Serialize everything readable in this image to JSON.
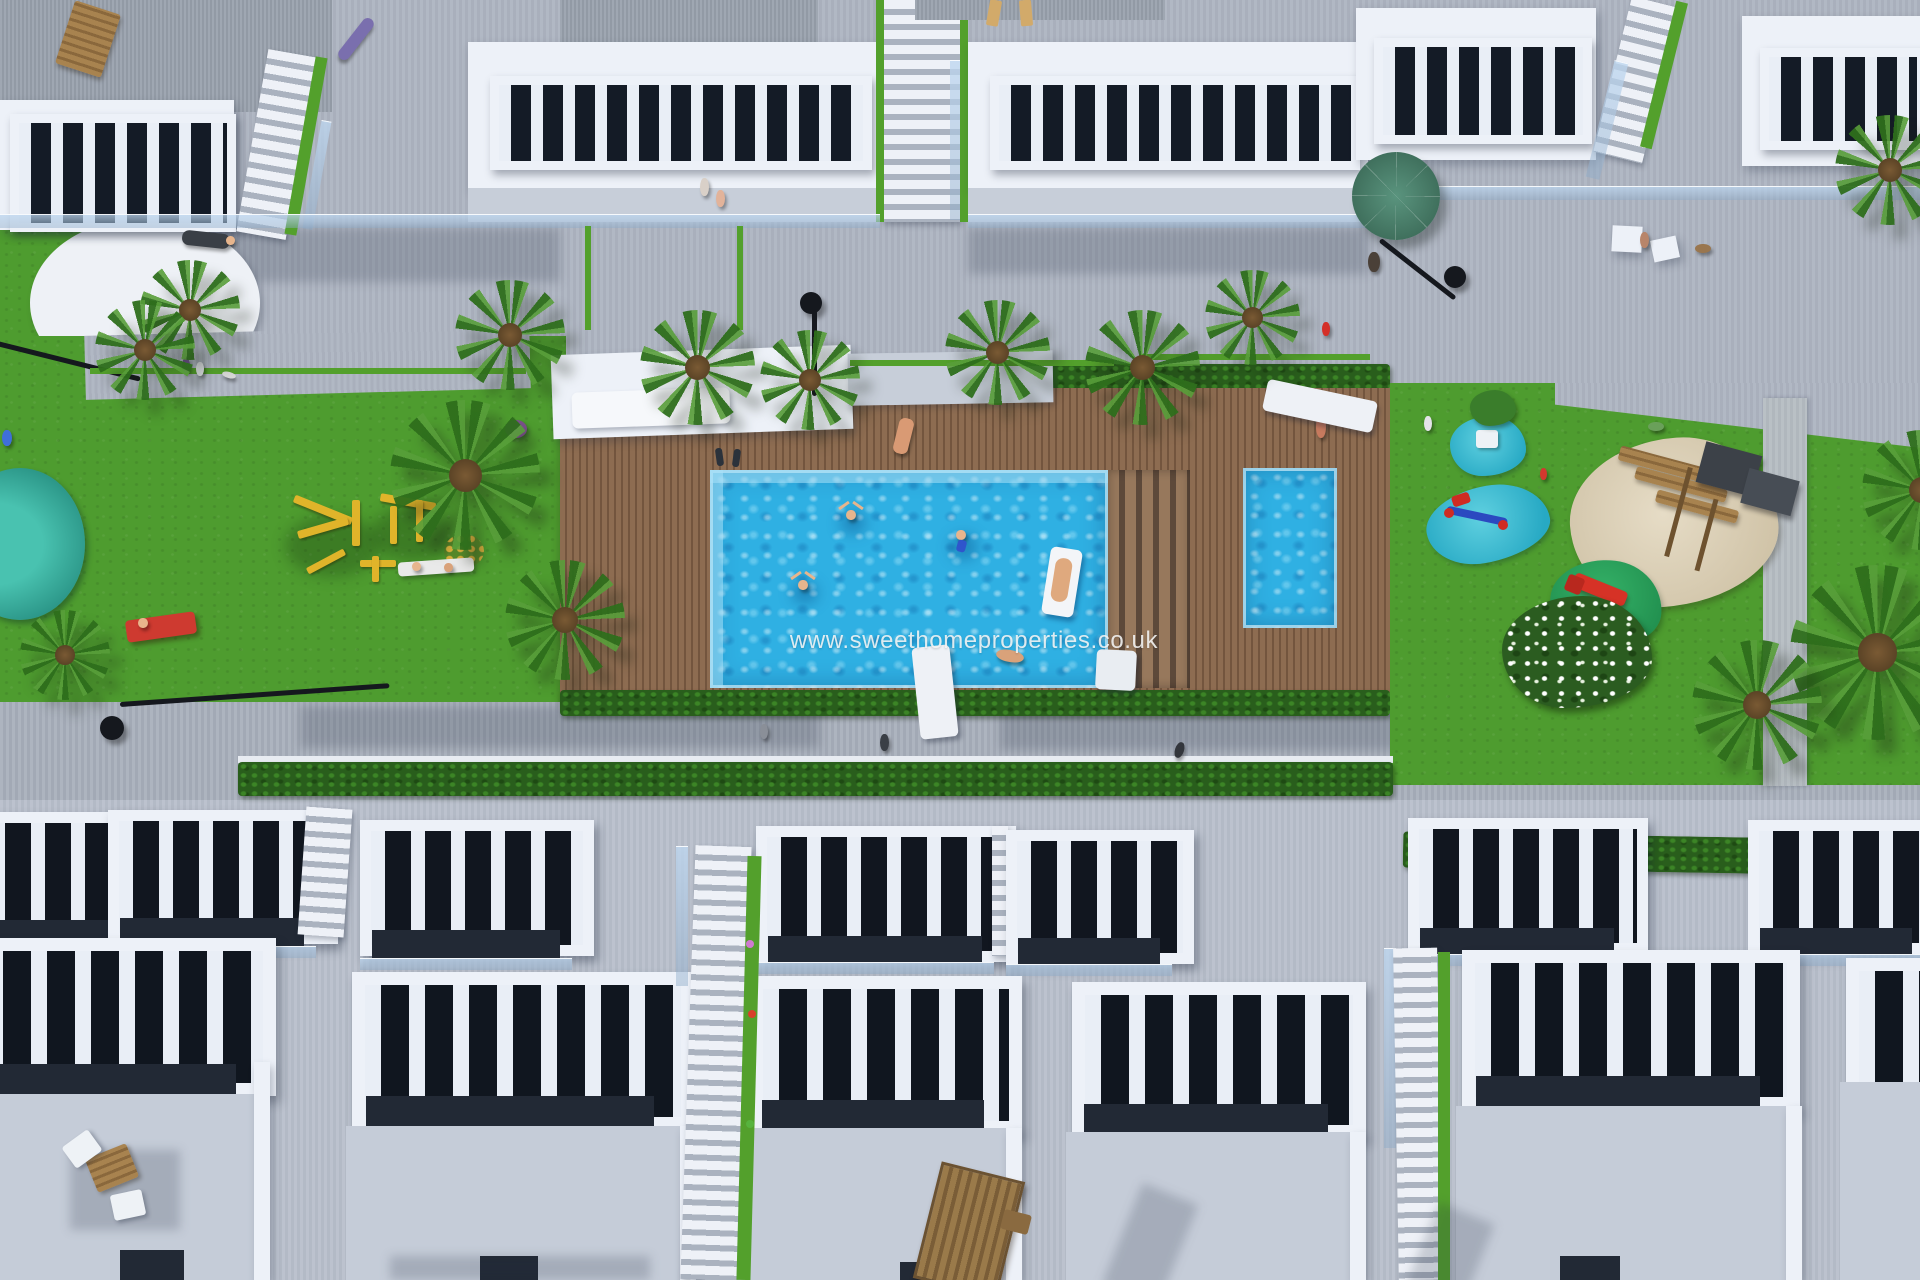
{
  "watermark": {
    "text": "www.sweethomeproperties.co.uk"
  },
  "palette": {
    "paving": "#aeb5c2",
    "paving_dark": "#a9b0bc",
    "building_white": "#edf1f8",
    "wall_gray": "#c7ced9",
    "roof_gray": "#9aa2ae",
    "lawn_green": "#4e9c2f",
    "accent_green": "#53a02c",
    "hedge_green": "#295e1c",
    "deck_brown": "#8d6c51",
    "pool_blue": "#2fb0e3",
    "splash_turquoise": "#27a9c4",
    "sand_beige": "#cfc2a6",
    "playground_yellow": "#e0b42a",
    "parasol_green": "#3f6f5c",
    "pond_teal": "#2a9486"
  }
}
